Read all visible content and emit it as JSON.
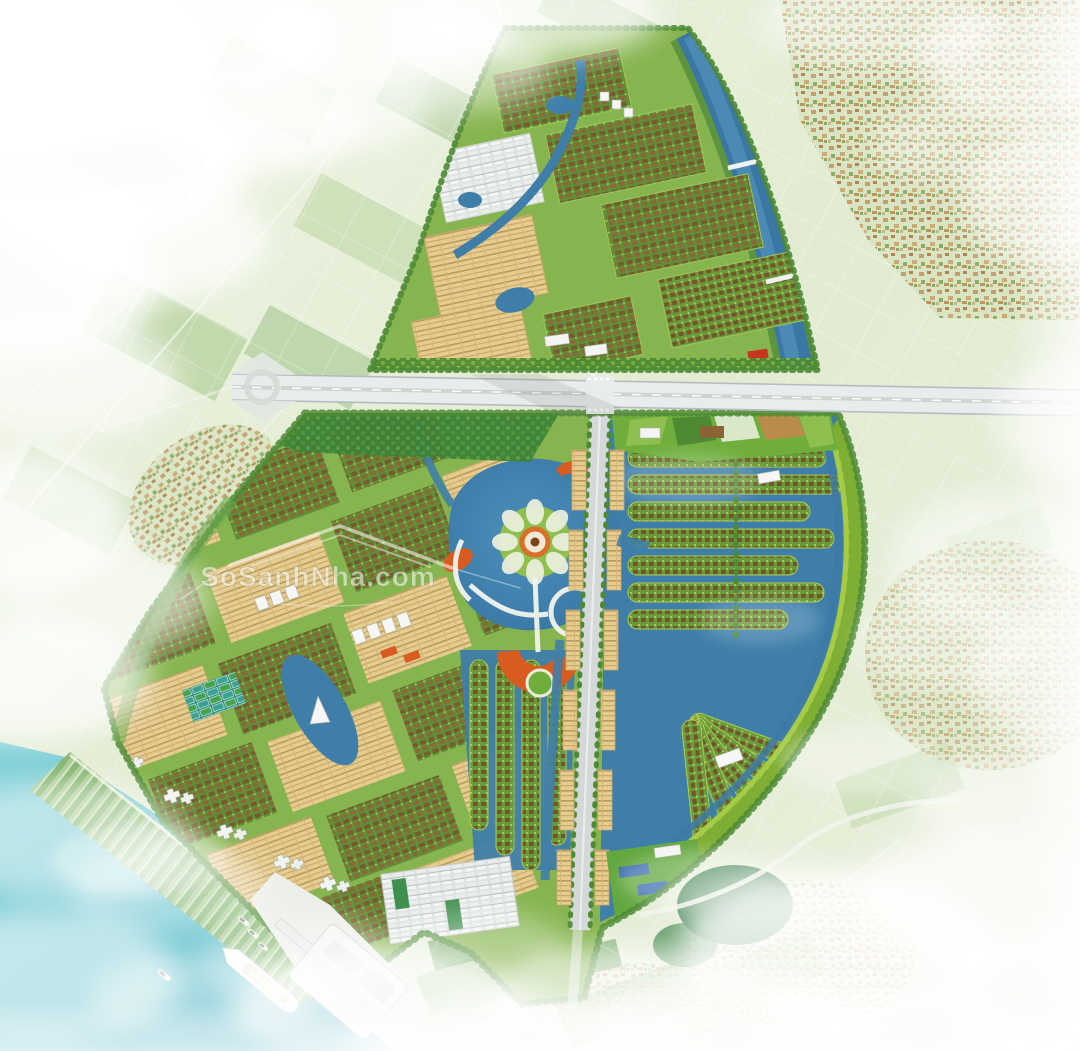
{
  "watermark": {
    "brand": "SoSanhNha.com",
    "icon": "house-roof-icon"
  },
  "palette": {
    "haze_white": "#ffffff",
    "field_light": "#e9f0dd",
    "field_green": "#9cc285",
    "forest_green": "#2f7a3c",
    "development_green": "#86b44e",
    "perimeter_arc_green": "#a6cc45",
    "tree_green": "#4c8a34",
    "canal_blue": "#3d7aa6",
    "lake_blue": "#3f7ea9",
    "river_teal": "#5fc0cc",
    "village_tan": "#c49a66",
    "villa_roof_brown": "#7a5930",
    "shophouse_tan": "#e6cc8e",
    "road_white": "#e9eced",
    "accent_orange": "#d85c20",
    "building_white": "#f4f5f2",
    "school_roof_blue": "#3f6fb0",
    "school_roof_red": "#c5361f",
    "ship_white": "#fdfdfb"
  }
}
